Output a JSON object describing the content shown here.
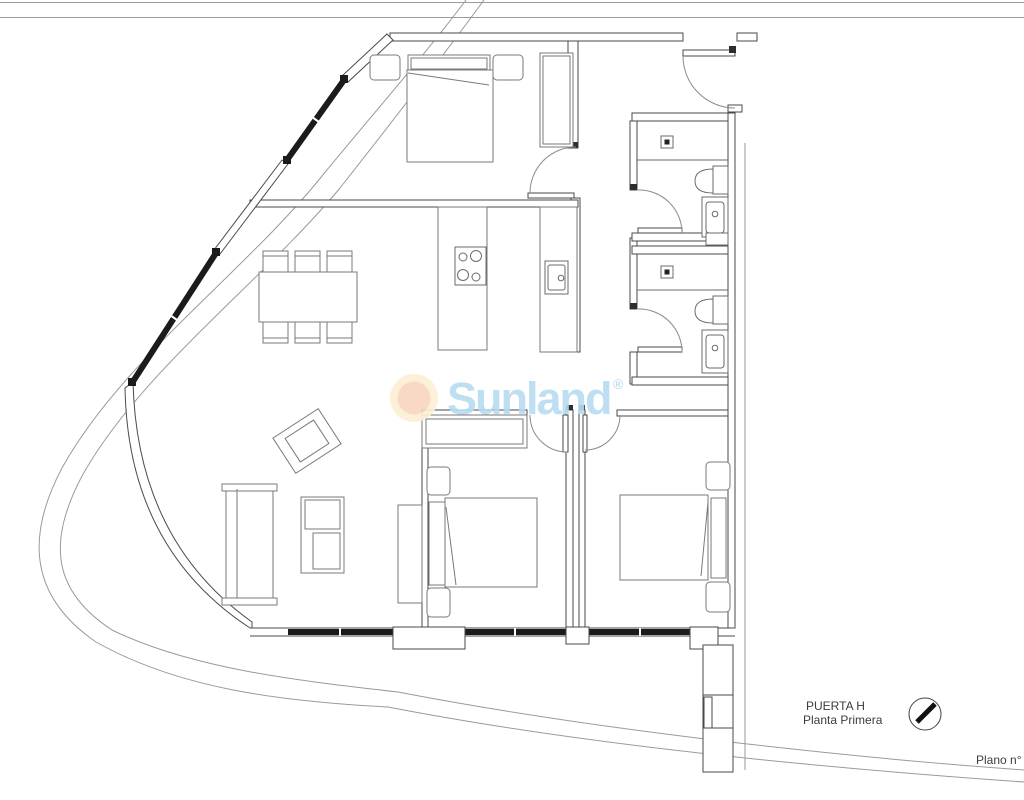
{
  "sheet": {
    "background": "#ffffff"
  },
  "watermark": {
    "brand": "Sunland",
    "registered_mark": "®",
    "brand_color": "#b7dcf0",
    "badge_outer_color": "#fcefd3",
    "badge_inner_color": "#f7d5c0"
  },
  "title_block": {
    "unit_label": "PUERTA H",
    "floor_label": "Planta Primera",
    "sheet_number_label": "Plano n°"
  },
  "drawing": {
    "wall_color": "#4a4a4a",
    "furniture_color": "#7a7a7a",
    "glazing_color": "#1b1b1b",
    "boundary_color": "#9a9a9a"
  }
}
